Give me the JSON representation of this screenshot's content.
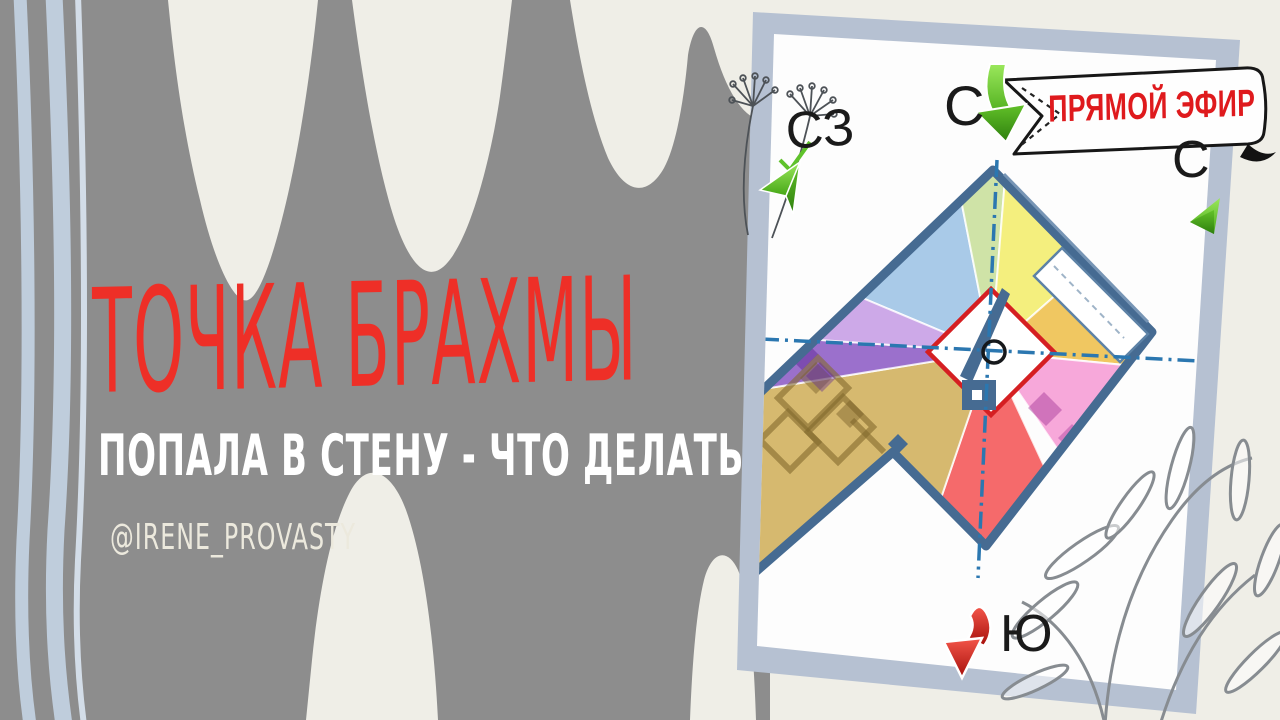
{
  "page": {
    "canvas_color": "#efeee7",
    "brush_color": "#8d8d8d",
    "stripe_color": "#bfcddc",
    "card_border_color": "#b6c1d2",
    "card_face_color": "#fdfdfd"
  },
  "title": {
    "text": "ТОЧКА БРАХМЫ",
    "color": "#ee2f27"
  },
  "subtitle": {
    "text": "ПОПАЛА В СТЕНУ - ЧТО ДЕЛАТЬ",
    "color": "#ffffff"
  },
  "handle": {
    "text": "@IRENE_PROVASTY",
    "color": "#ece9dd"
  },
  "live_badge": {
    "text": "ПРЯМОЙ ЭФИР",
    "text_color": "#df1a1d",
    "ribbon_color": "#fefefe",
    "outline_color": "#171717"
  },
  "compass": {
    "color": "#1a1a1a",
    "north_top": "С",
    "northwest": "СЗ",
    "north_right": "С",
    "south": "Ю"
  },
  "plan": {
    "wall_color": "#466b92",
    "wall_inner_color": "#7795b5",
    "axis_color": "#2b77b0",
    "brahma_square_color": "#d51f22",
    "brahma_point_color": "#16181b",
    "sectors": {
      "northwest_blue": "#a9cae8",
      "north_green": "#cfe3a7",
      "northeast_yellow": "#f4ef7e",
      "east_orange": "#f0c761",
      "southeast_pink": "#f7a8da",
      "south_red": "#f56a6b",
      "southwest_tan": "#d6b96f",
      "west_purple": "#9b70cc",
      "west_lavender": "#cda9e8"
    }
  },
  "arrows": {
    "green_light": "#8fe24d",
    "green_dark": "#3f9c12",
    "red_light": "#f25244",
    "red_dark": "#a50f0a"
  },
  "sketches": {
    "ink_color": "#4d5257",
    "leaf_color": "#878c91"
  }
}
